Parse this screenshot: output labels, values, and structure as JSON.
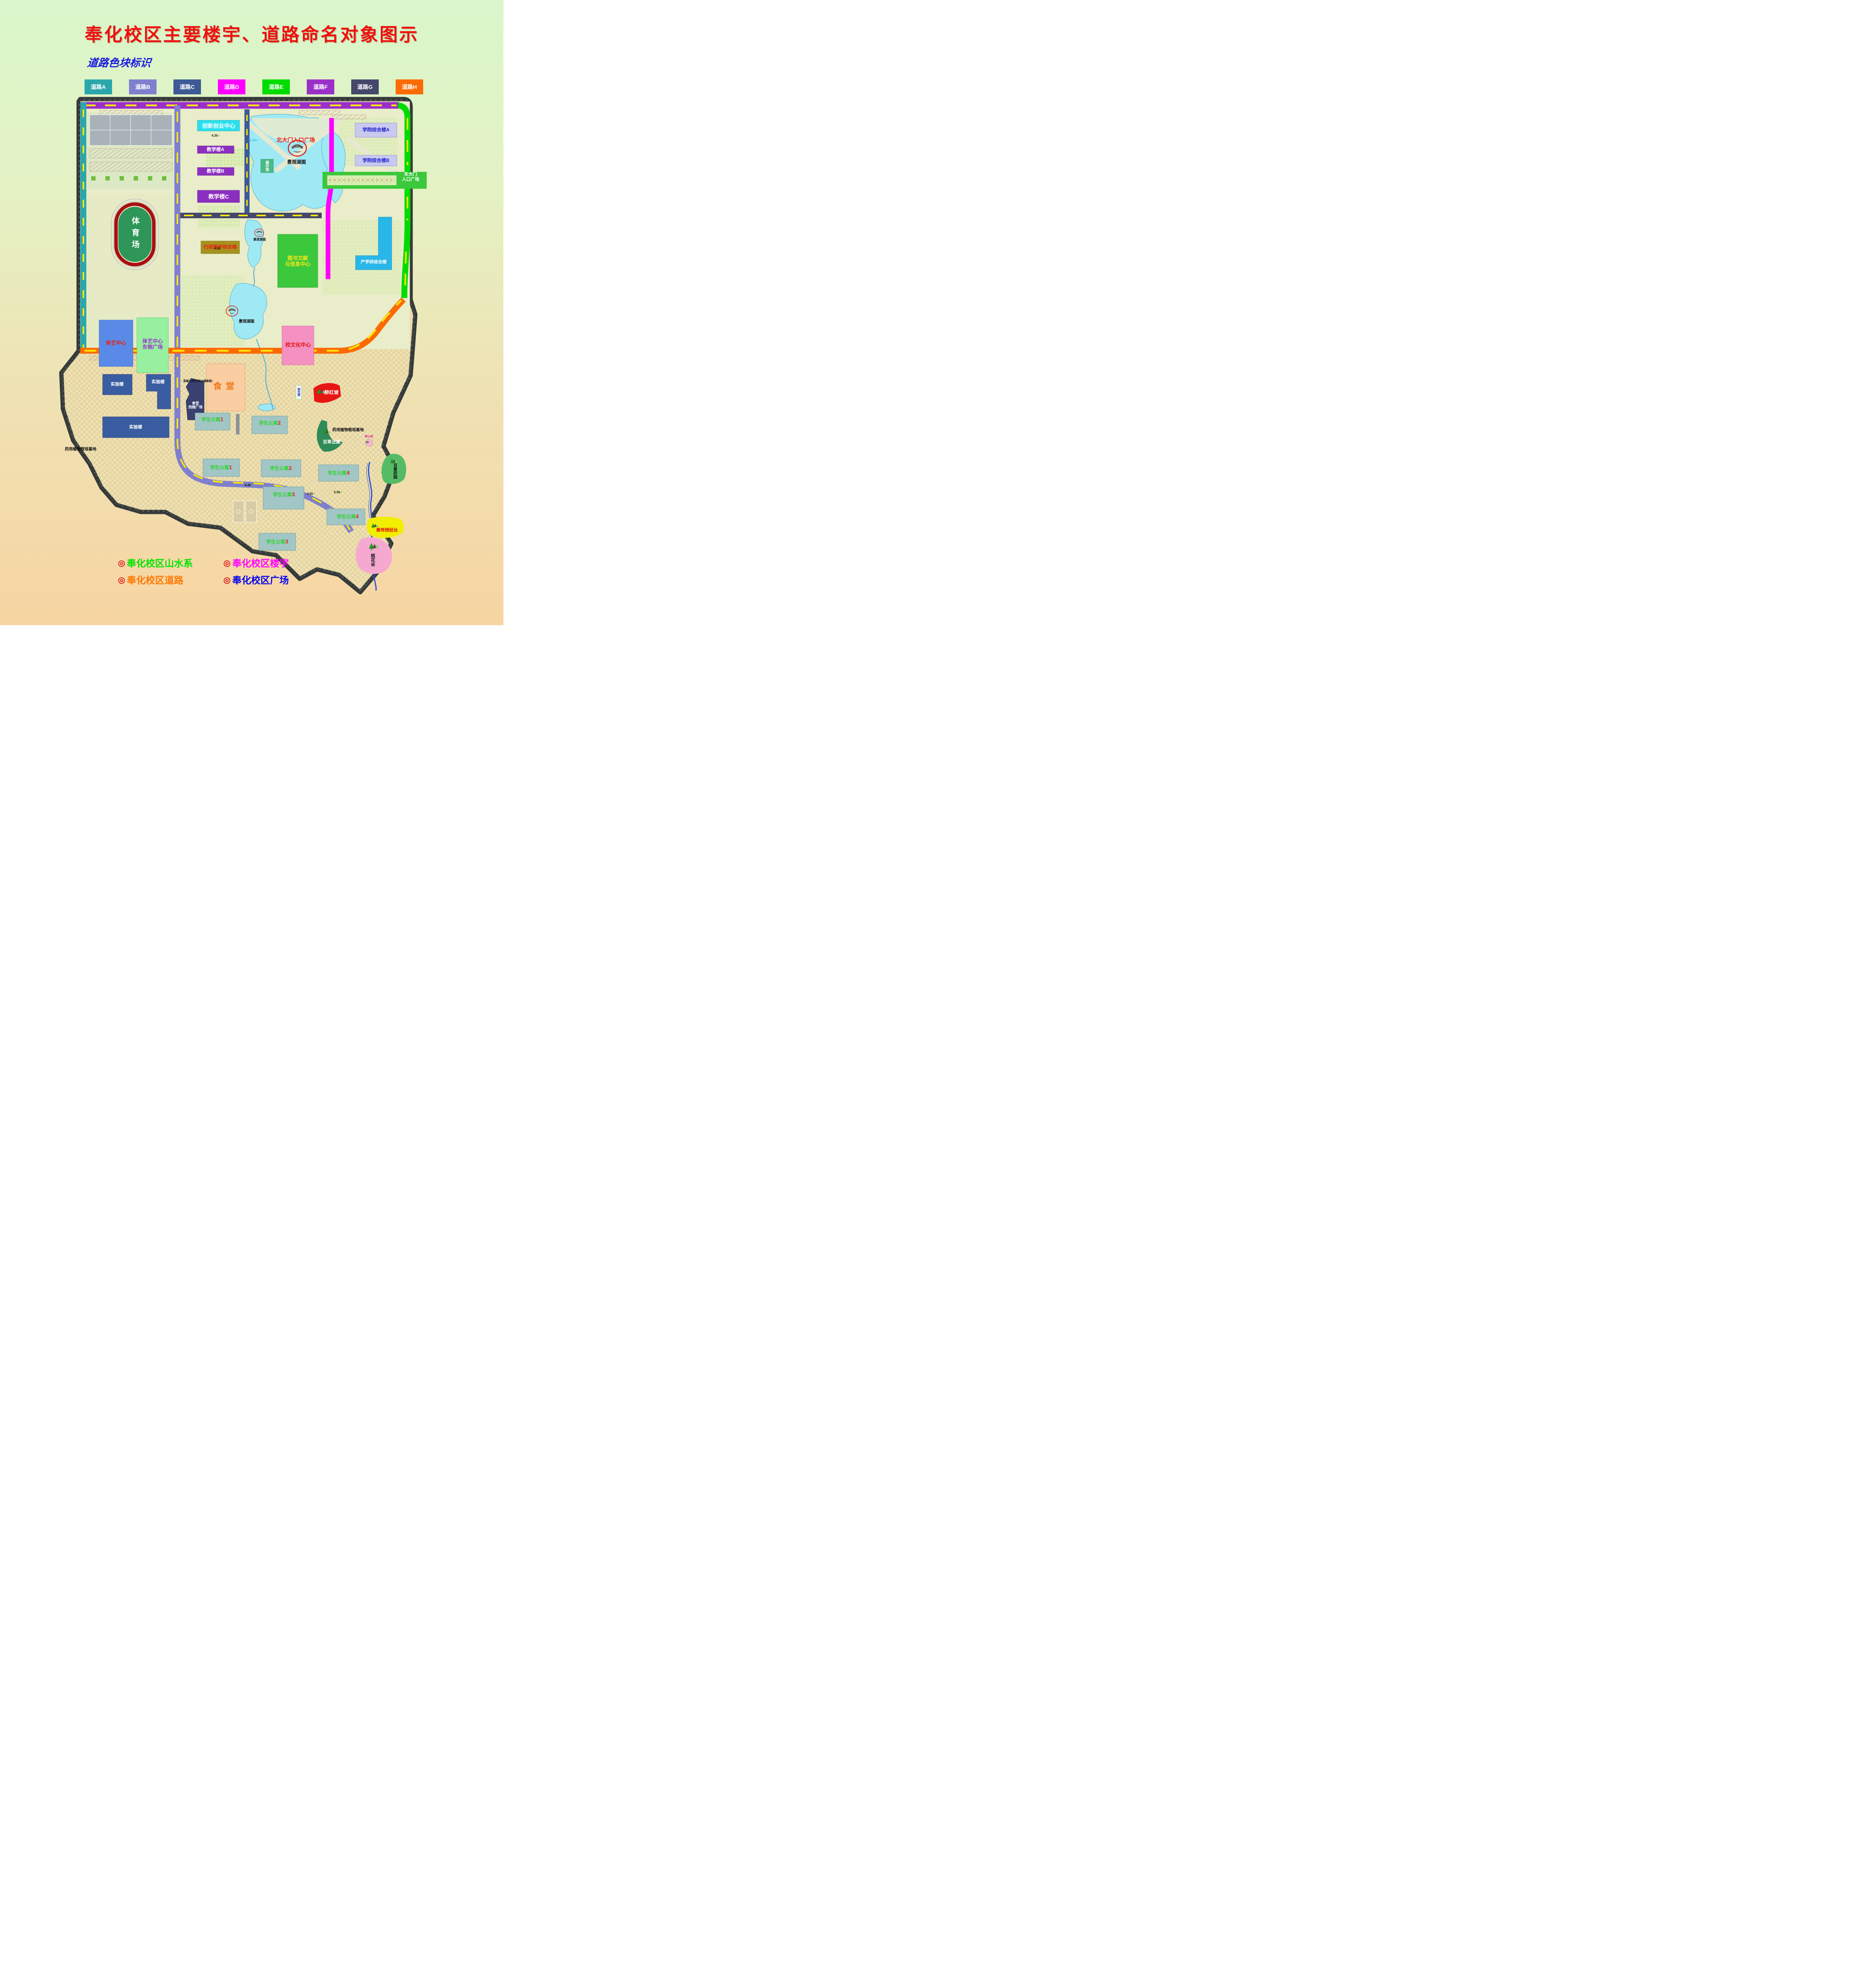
{
  "title": "奉化校区主要楼宇、道路命名对象图示",
  "subtitle": "道路色块标识",
  "road_legend": {
    "items": [
      {
        "label": "道路A",
        "color": "#2AA7AB"
      },
      {
        "label": "道路B",
        "color": "#7F7FCE"
      },
      {
        "label": "道路C",
        "color": "#3D5A96"
      },
      {
        "label": "道路D",
        "color": "#FF00FF"
      },
      {
        "label": "道路E",
        "color": "#00DC00"
      },
      {
        "label": "道路F",
        "color": "#9B30C8"
      },
      {
        "label": "道路G",
        "color": "#45476B"
      },
      {
        "label": "道路H",
        "color": "#FB6B02"
      }
    ]
  },
  "map": {
    "plazas": {
      "north_gate": "北大门入口广场",
      "east_gate_line1": "东大门",
      "east_gate_line2": "入口广场",
      "tiyi_east_line1": "体艺中心",
      "tiyi_east_line2": "东侧广场",
      "canteen_west_line1": "食堂",
      "canteen_west_line2": "西侧广场"
    },
    "buildings": {
      "innovation_center": "创新创业中心",
      "teaching_a": "教学楼A",
      "teaching_b": "教学楼B",
      "teaching_c": "教学楼C",
      "college_complex_a": "学院综合楼A",
      "college_complex_b": "学院综合楼B",
      "exhibition_hall": "展示馆",
      "admin_service": "行政服务综合楼",
      "library_line1": "图书文献",
      "library_line2": "与信息中心",
      "industry_research": "产学研综合楼",
      "stadium": "体育场",
      "sports_art_center": "体艺中心",
      "culture_center": "校文化中心",
      "lab_building": "实验楼",
      "canteen": "食堂",
      "dorm": "学生公寓",
      "dorm1_no": "1",
      "dorm2_no": "2",
      "dorm3_no": "3",
      "dorm4_no": "4",
      "watch_tower": "观光塔"
    },
    "landscape": {
      "lake": "景观湖面",
      "zuihongpo": "醉红坡",
      "baicao": "百草云集",
      "baiguo": "百果药园",
      "huangdi": "黄帝授经台",
      "taohua": "桃花谷",
      "yangxin": "养心吧",
      "herb_base": "药用植物栽培基地"
    },
    "notes": {
      "drain": "混凝土排水沟(上铺盖板)"
    },
    "elevations": {
      "e1": "4.35",
      "e2": "4.30",
      "e3": "4.35",
      "e4": "4.40",
      "e5": "4.50",
      "e6": "5.00"
    }
  },
  "bottom_legend": {
    "bullet": "◎",
    "items": [
      {
        "label": "奉化校区山水系",
        "color": "#00E400"
      },
      {
        "label": "奉化校区楼宇",
        "color": "#FF00FF"
      },
      {
        "label": "奉化校区道路",
        "color": "#FF7700"
      },
      {
        "label": "奉化校区广场",
        "color": "#0000EE"
      }
    ]
  }
}
